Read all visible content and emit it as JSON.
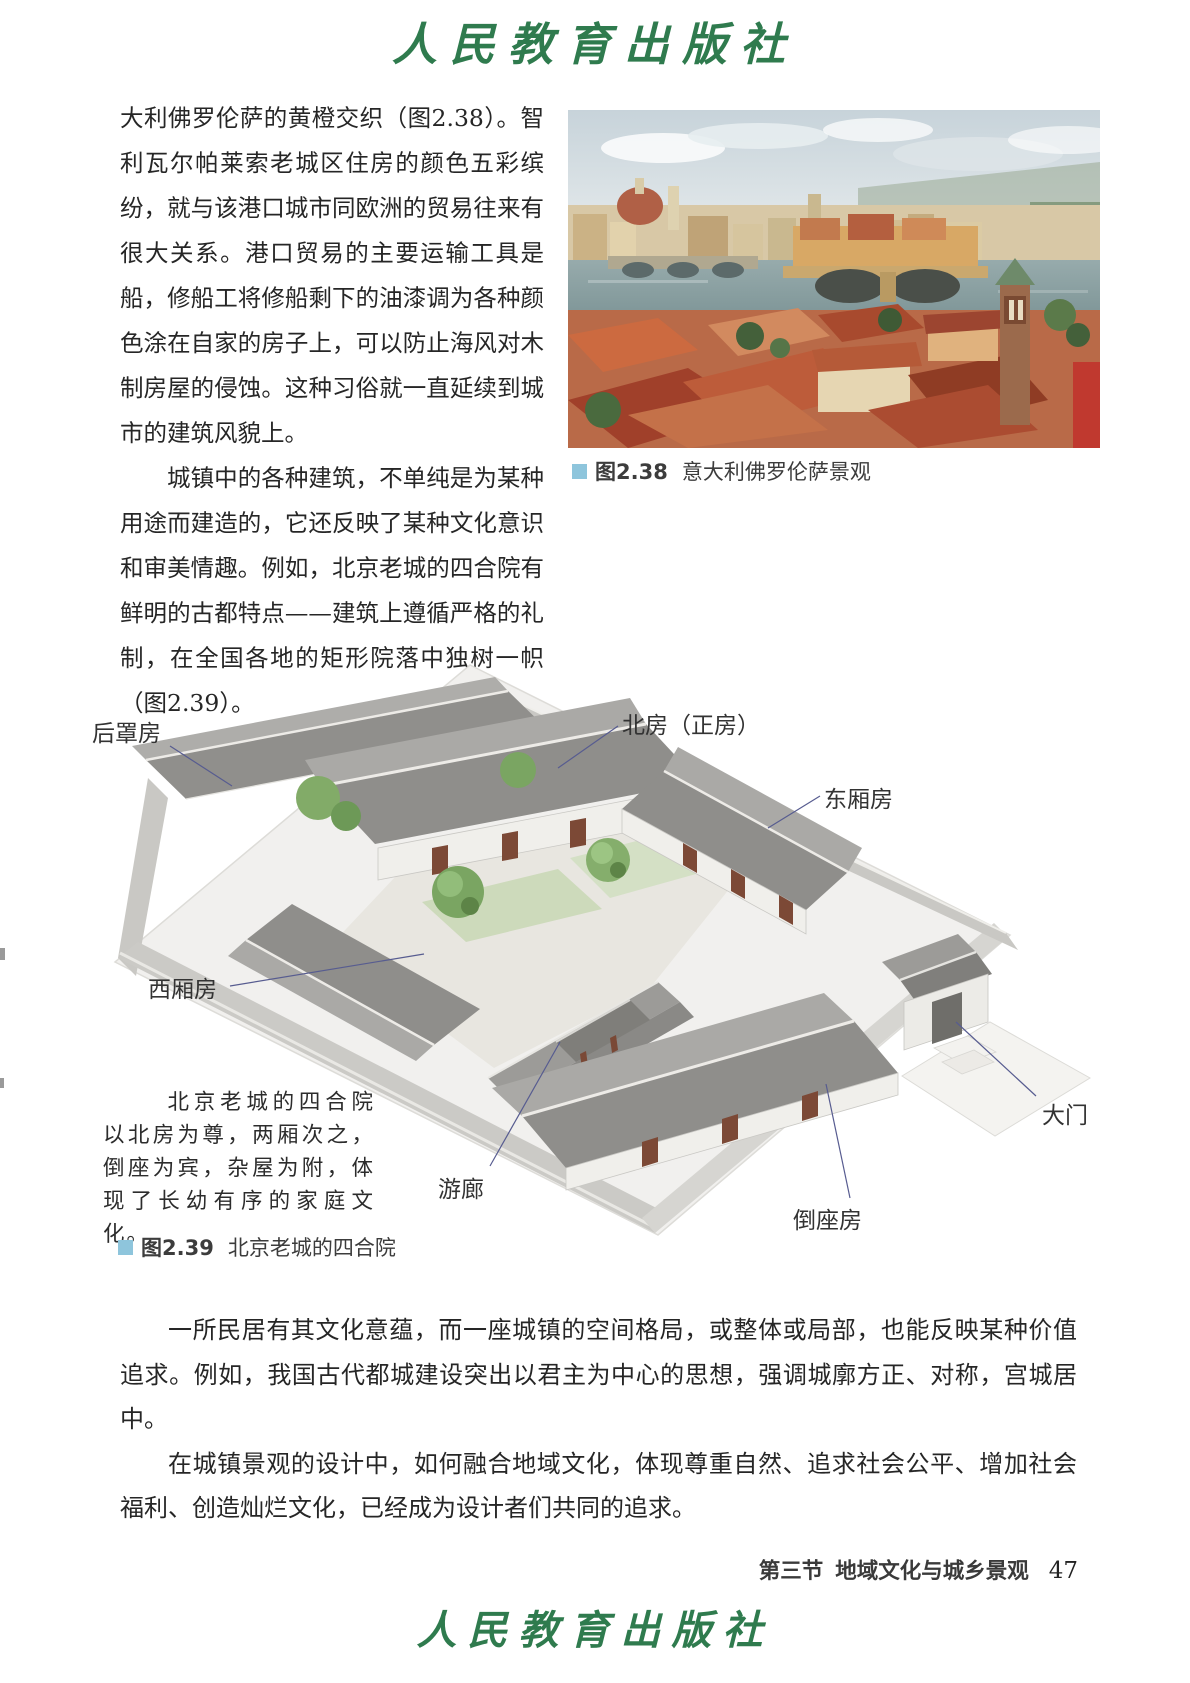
{
  "header": {
    "publisher": "人民教育出版社"
  },
  "body": {
    "p1": "大利佛罗伦萨的黄橙交织（图2.38）。智利瓦尔帕莱索老城区住房的颜色五彩缤纷，就与该港口城市同欧洲的贸易往来有很大关系。港口贸易的主要运输工具是船，修船工将修船剩下的油漆调为各种颜色涂在自家的房子上，可以防止海风对木制房屋的侵蚀。这种习俗就一直延续到城市的建筑风貌上。",
    "p2": "城镇中的各种建筑，不单纯是为某种用途而建造的，它还反映了某种文化意识和审美情趣。例如，北京老城的四合院有鲜明的古都特点——建筑上遵循严格的礼制，在全国各地的矩形院落中独树一帜（图2.39）。",
    "p3": "一所民居有其文化意蕴，而一座城镇的空间格局，或整体或局部，也能反映某种价值追求。例如，我国古代都城建设突出以君主为中心的思想，强调城廓方正、对称，宫城居中。",
    "p4": "在城镇景观的设计中，如何融合地域文化，体现尊重自然、追求社会公平、增加社会福利、创造灿烂文化，已经成为设计者们共同的追求。"
  },
  "figure238": {
    "label": "图2.38",
    "caption": "意大利佛罗伦萨景观",
    "marker_color": "#8ec5dc"
  },
  "figure239": {
    "label": "图2.39",
    "caption": "北京老城的四合院",
    "marker_color": "#8ec5dc",
    "note": "北京老城的四合院以北房为尊，两厢次之，倒座为宾，杂屋为附，体现了长幼有序的家庭文化。",
    "labels": [
      {
        "id": "rear-building",
        "text": "后罩房"
      },
      {
        "id": "north-house",
        "text": "北房（正房）"
      },
      {
        "id": "east-wing",
        "text": "东厢房"
      },
      {
        "id": "west-wing",
        "text": "西厢房"
      },
      {
        "id": "corridor",
        "text": "游廊"
      },
      {
        "id": "main-gate",
        "text": "大门"
      },
      {
        "id": "reverse-house",
        "text": "倒座房"
      }
    ]
  },
  "footer": {
    "section": "第三节",
    "chapter": "地域文化与城乡景观",
    "page_number": "47",
    "publisher": "人民教育出版社"
  },
  "colors": {
    "logo_green": "#2f7b4e",
    "caption_marker_blue": "#8ec5dc",
    "leader_line": "#575c90",
    "body_text": "#262626"
  }
}
